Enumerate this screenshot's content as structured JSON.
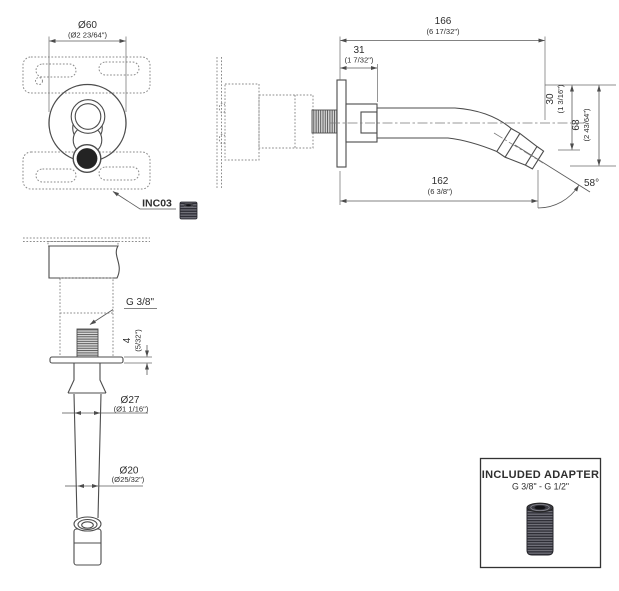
{
  "drawing": {
    "product_code": "INC03",
    "front_view": {
      "dia60_mm": "Ø60",
      "dia60_in": "(Ø2 23/64\")"
    },
    "side_view": {
      "len166_mm": "166",
      "len166_in": "(6 17/32\")",
      "len31_mm": "31",
      "len31_in": "(1 7/32\")",
      "h30_mm": "30",
      "h30_in": "(1 3/16\")",
      "h68_mm": "68",
      "h68_in": "(2 43/64\")",
      "len162_mm": "162",
      "len162_in": "(6 3/8\")",
      "angle": "58°"
    },
    "bottom_view": {
      "thread_label": "G 3/8\"",
      "t4_mm": "4",
      "t4_in": "(5/32\")",
      "dia27_mm": "Ø27",
      "dia27_in": "(Ø1 1/16\")",
      "dia20_mm": "Ø20",
      "dia20_in": "(Ø25/32\")"
    },
    "adapter_box": {
      "title": "INCLUDED ADAPTER",
      "subtitle": "G 3/8\" - G 1/2\""
    }
  }
}
